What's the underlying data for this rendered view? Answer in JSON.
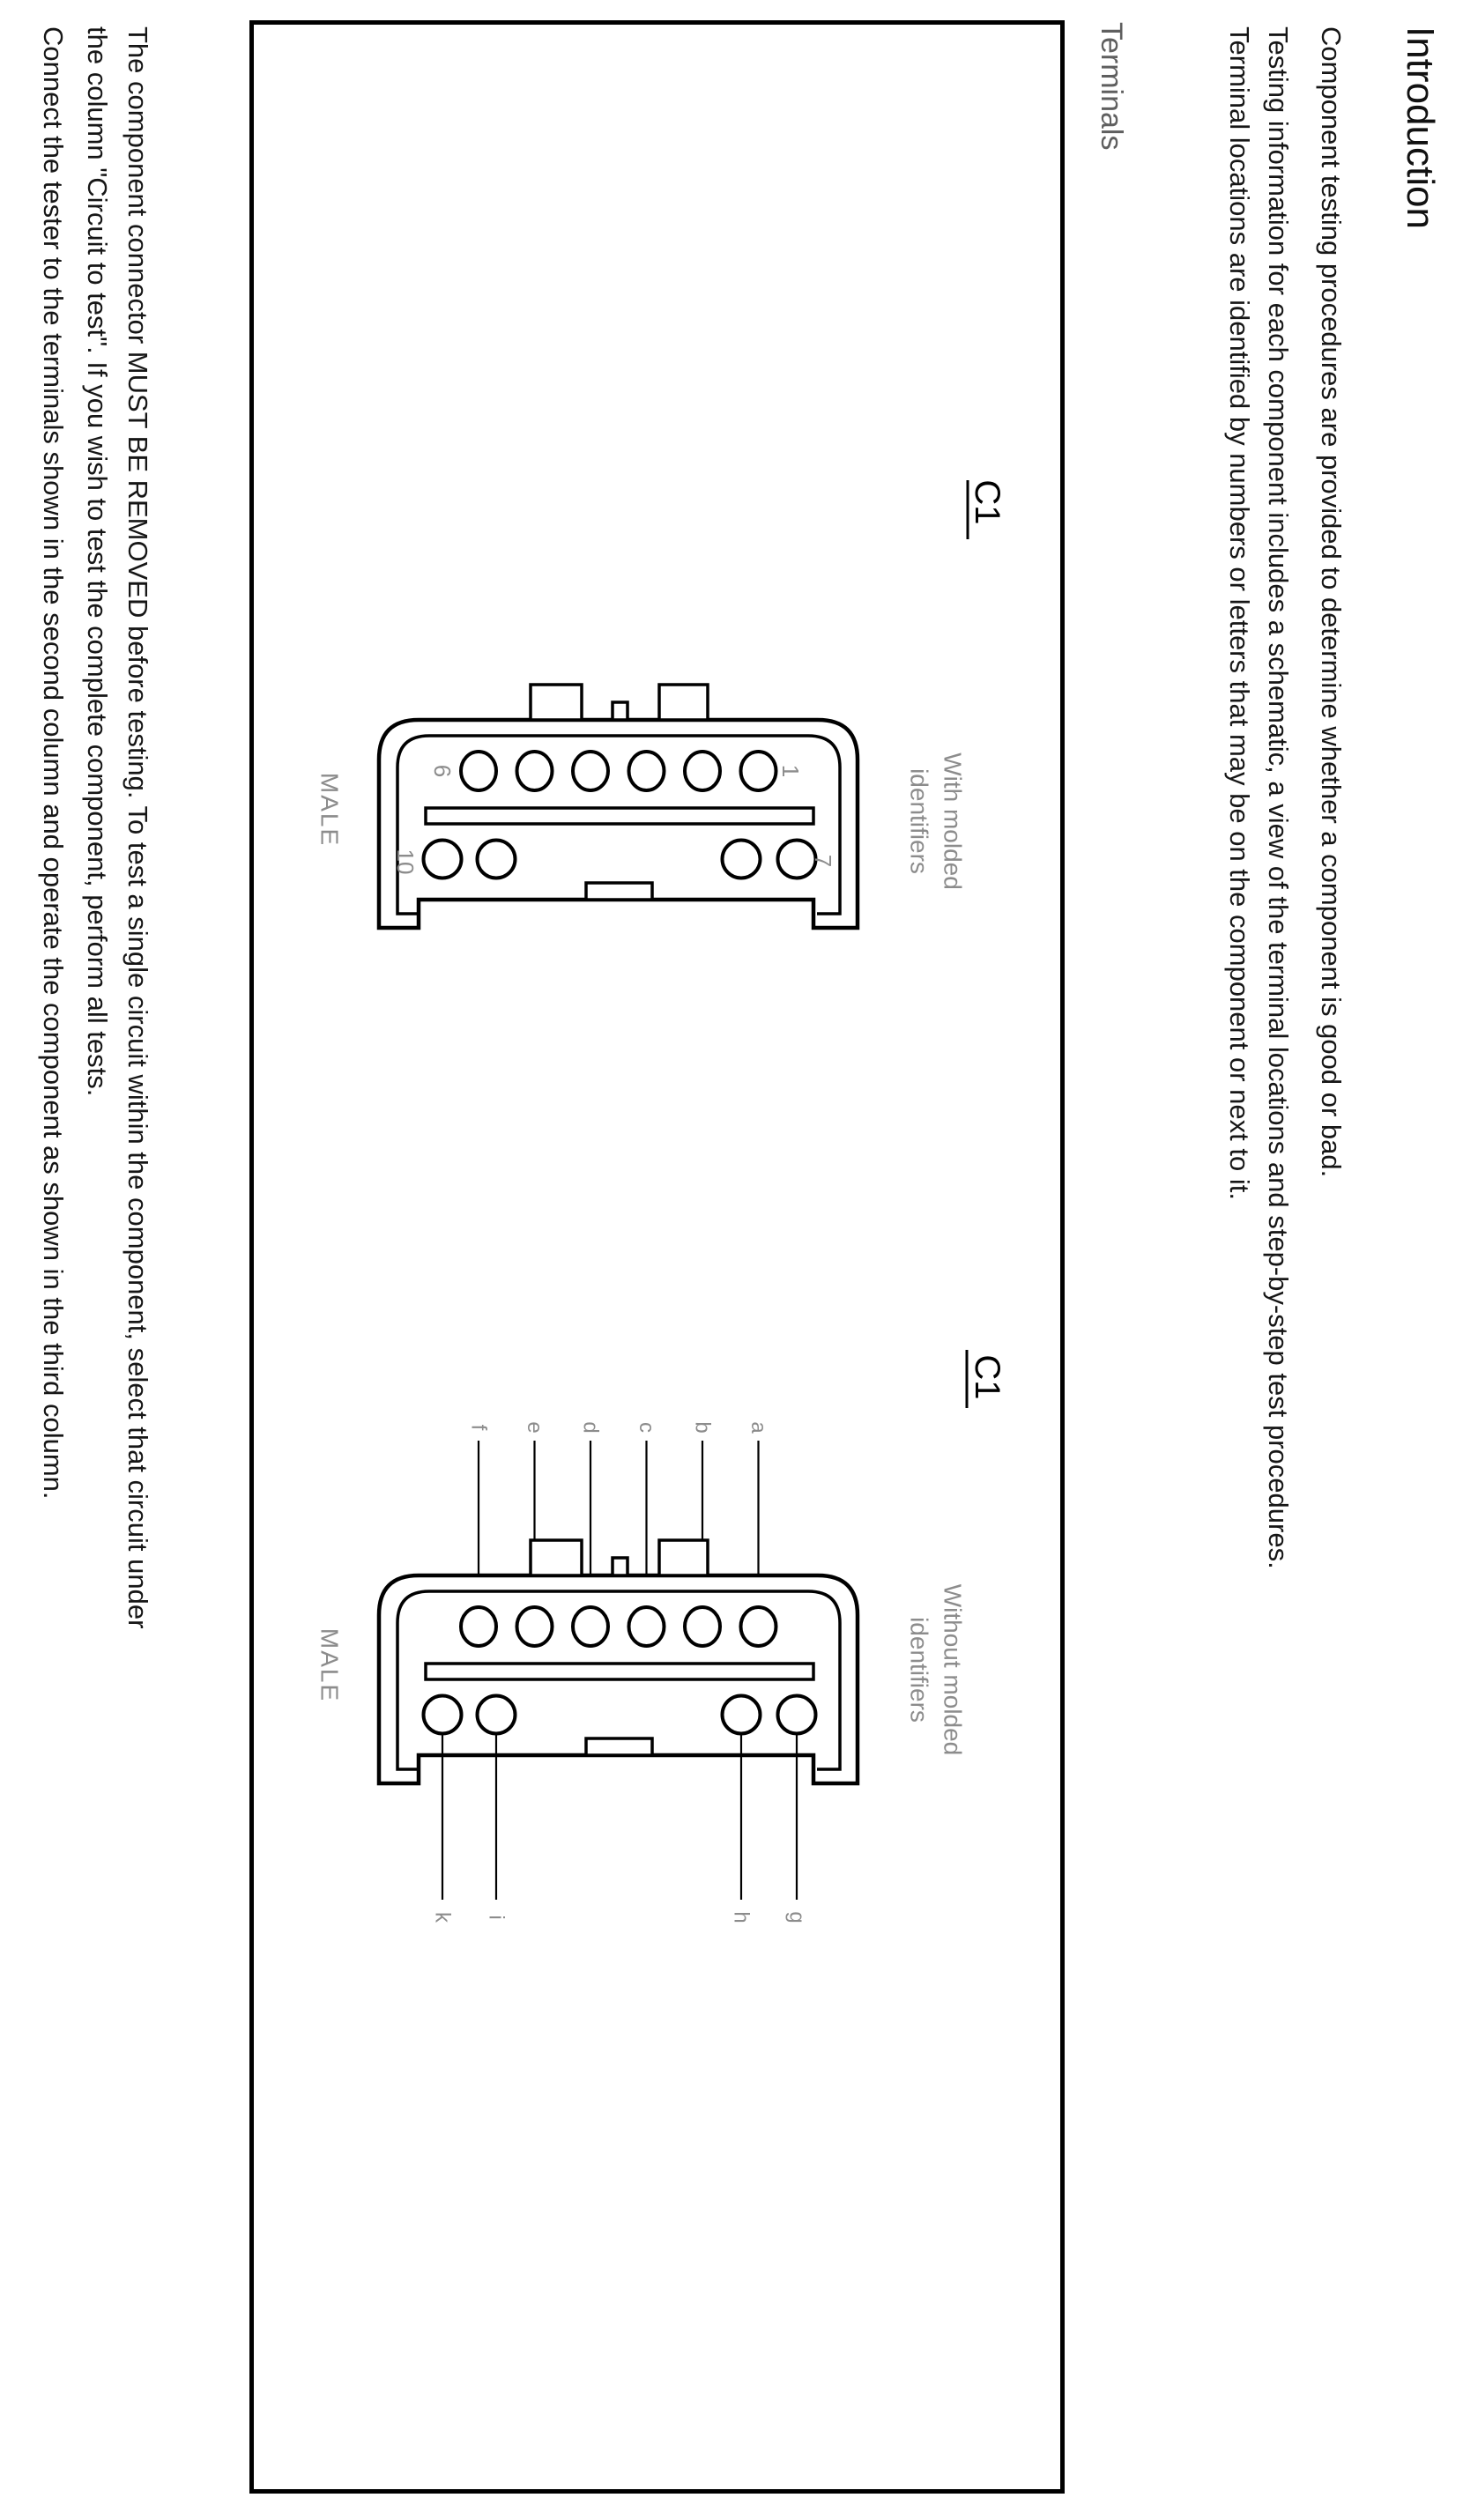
{
  "page": {
    "title": "Introduction",
    "intro_lines": [
      "Component testing procedures are provided to determine whether a component is good or bad.",
      "Testing information for each component includes a schematic, a view of the terminal locations and step-by-step test procedures.",
      "Terminal locations are identified by numbers or letters that may be on the component or next to it."
    ],
    "section_label": "Terminals",
    "footer_lines": [
      "The component connector MUST BE REMOVED before testing. To test a single circuit within the component, select that circuit under",
      "the column \"Circuit to test\". If you wish to test the complete component, perform all tests.",
      "Connect the tester to the terminals shown in the second column and operate the component as shown in the third column."
    ]
  },
  "figures": [
    {
      "connector_label": "C1",
      "gender_label": "MALE",
      "caption_line1": "With molded",
      "caption_line2": "identifiers",
      "pin_numbers": {
        "top_left": "6",
        "top_right": "1",
        "bottom_left": "10",
        "bottom_right": "7"
      }
    },
    {
      "connector_label": "C1",
      "gender_label": "MALE",
      "caption_line1": "Without molded",
      "caption_line2": "identifiers",
      "top_terminal_letters": [
        "f",
        "e",
        "d",
        "c",
        "b",
        "a"
      ],
      "bottom_terminal_letters": [
        "k",
        "i",
        "h",
        "g"
      ]
    }
  ],
  "colors": {
    "text": "#161616",
    "label_gray": "#8c8c8c",
    "line": "#000000"
  }
}
